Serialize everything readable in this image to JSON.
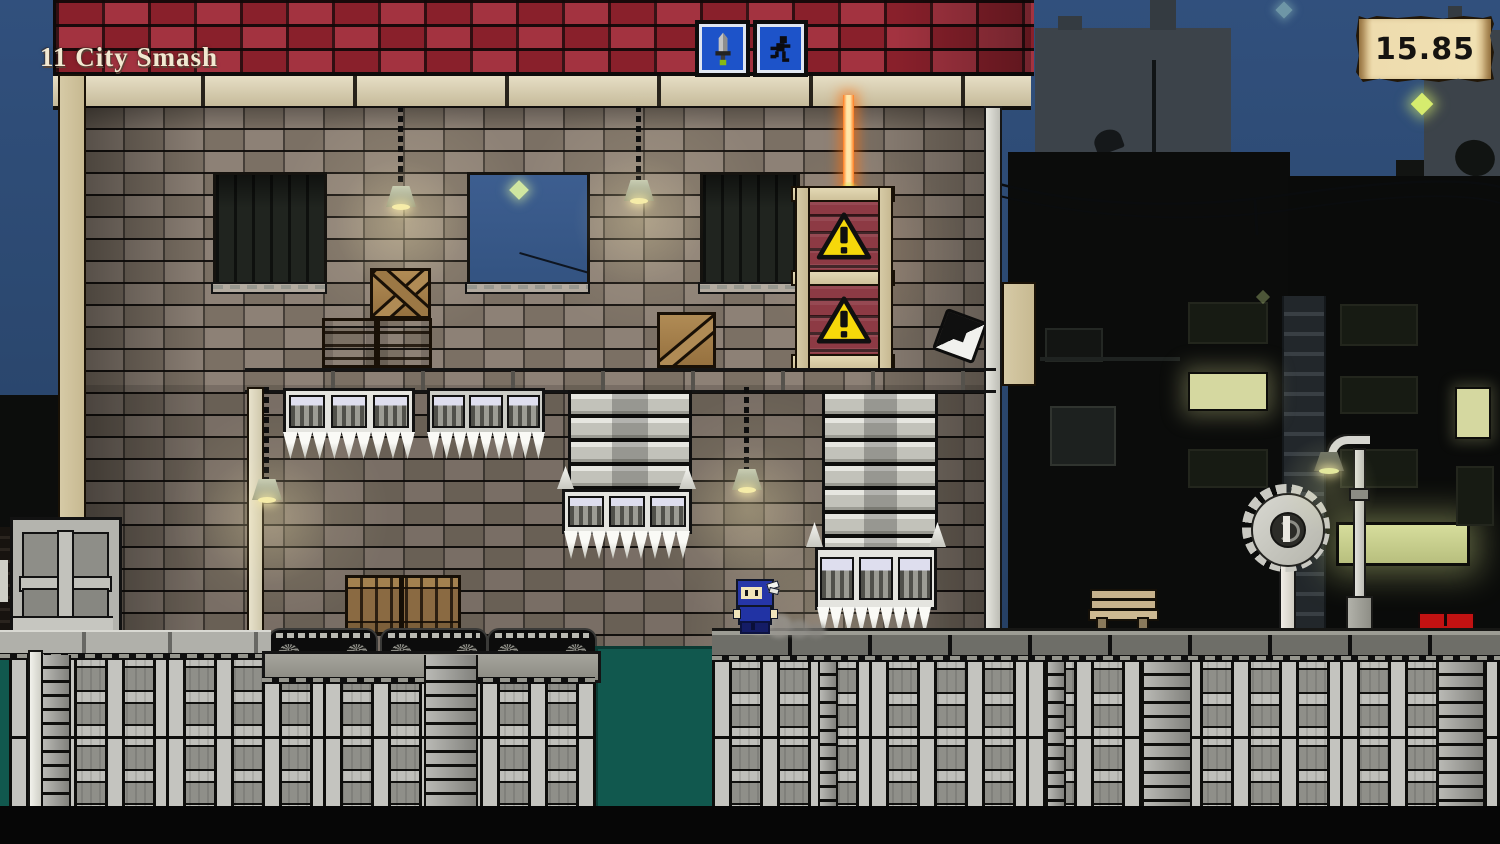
{
  "hud": {
    "level_label": "11 City Smash",
    "timer_value": "15.85"
  },
  "signs": {
    "left_sign_icon": "sword-icon",
    "right_sign_icon": "runner-icon",
    "sign_panel_color": "#1d53c9"
  },
  "hazards": {
    "warning_crate_icon": "exclamation-triangle-icon",
    "warning_crate_count": 2,
    "laser_color": "#ff7a1e",
    "saw_blade_count": 1
  },
  "pickups": {
    "shuriken_icon": "shuriken-icon"
  },
  "player": {
    "character": "ninja",
    "suit_color": "#2636a8"
  },
  "palette": {
    "sky": "#2c4971",
    "roof_brick": "#9c2431",
    "wall_brick": "#86796d",
    "beam_wood": "#dcd0ac",
    "ground_teal": "#11584e",
    "warning_yellow": "#f6d80a",
    "crate_red": "#8d3a44",
    "lit_window": "#d5d8a0",
    "parchment": "#f0e0b2"
  }
}
